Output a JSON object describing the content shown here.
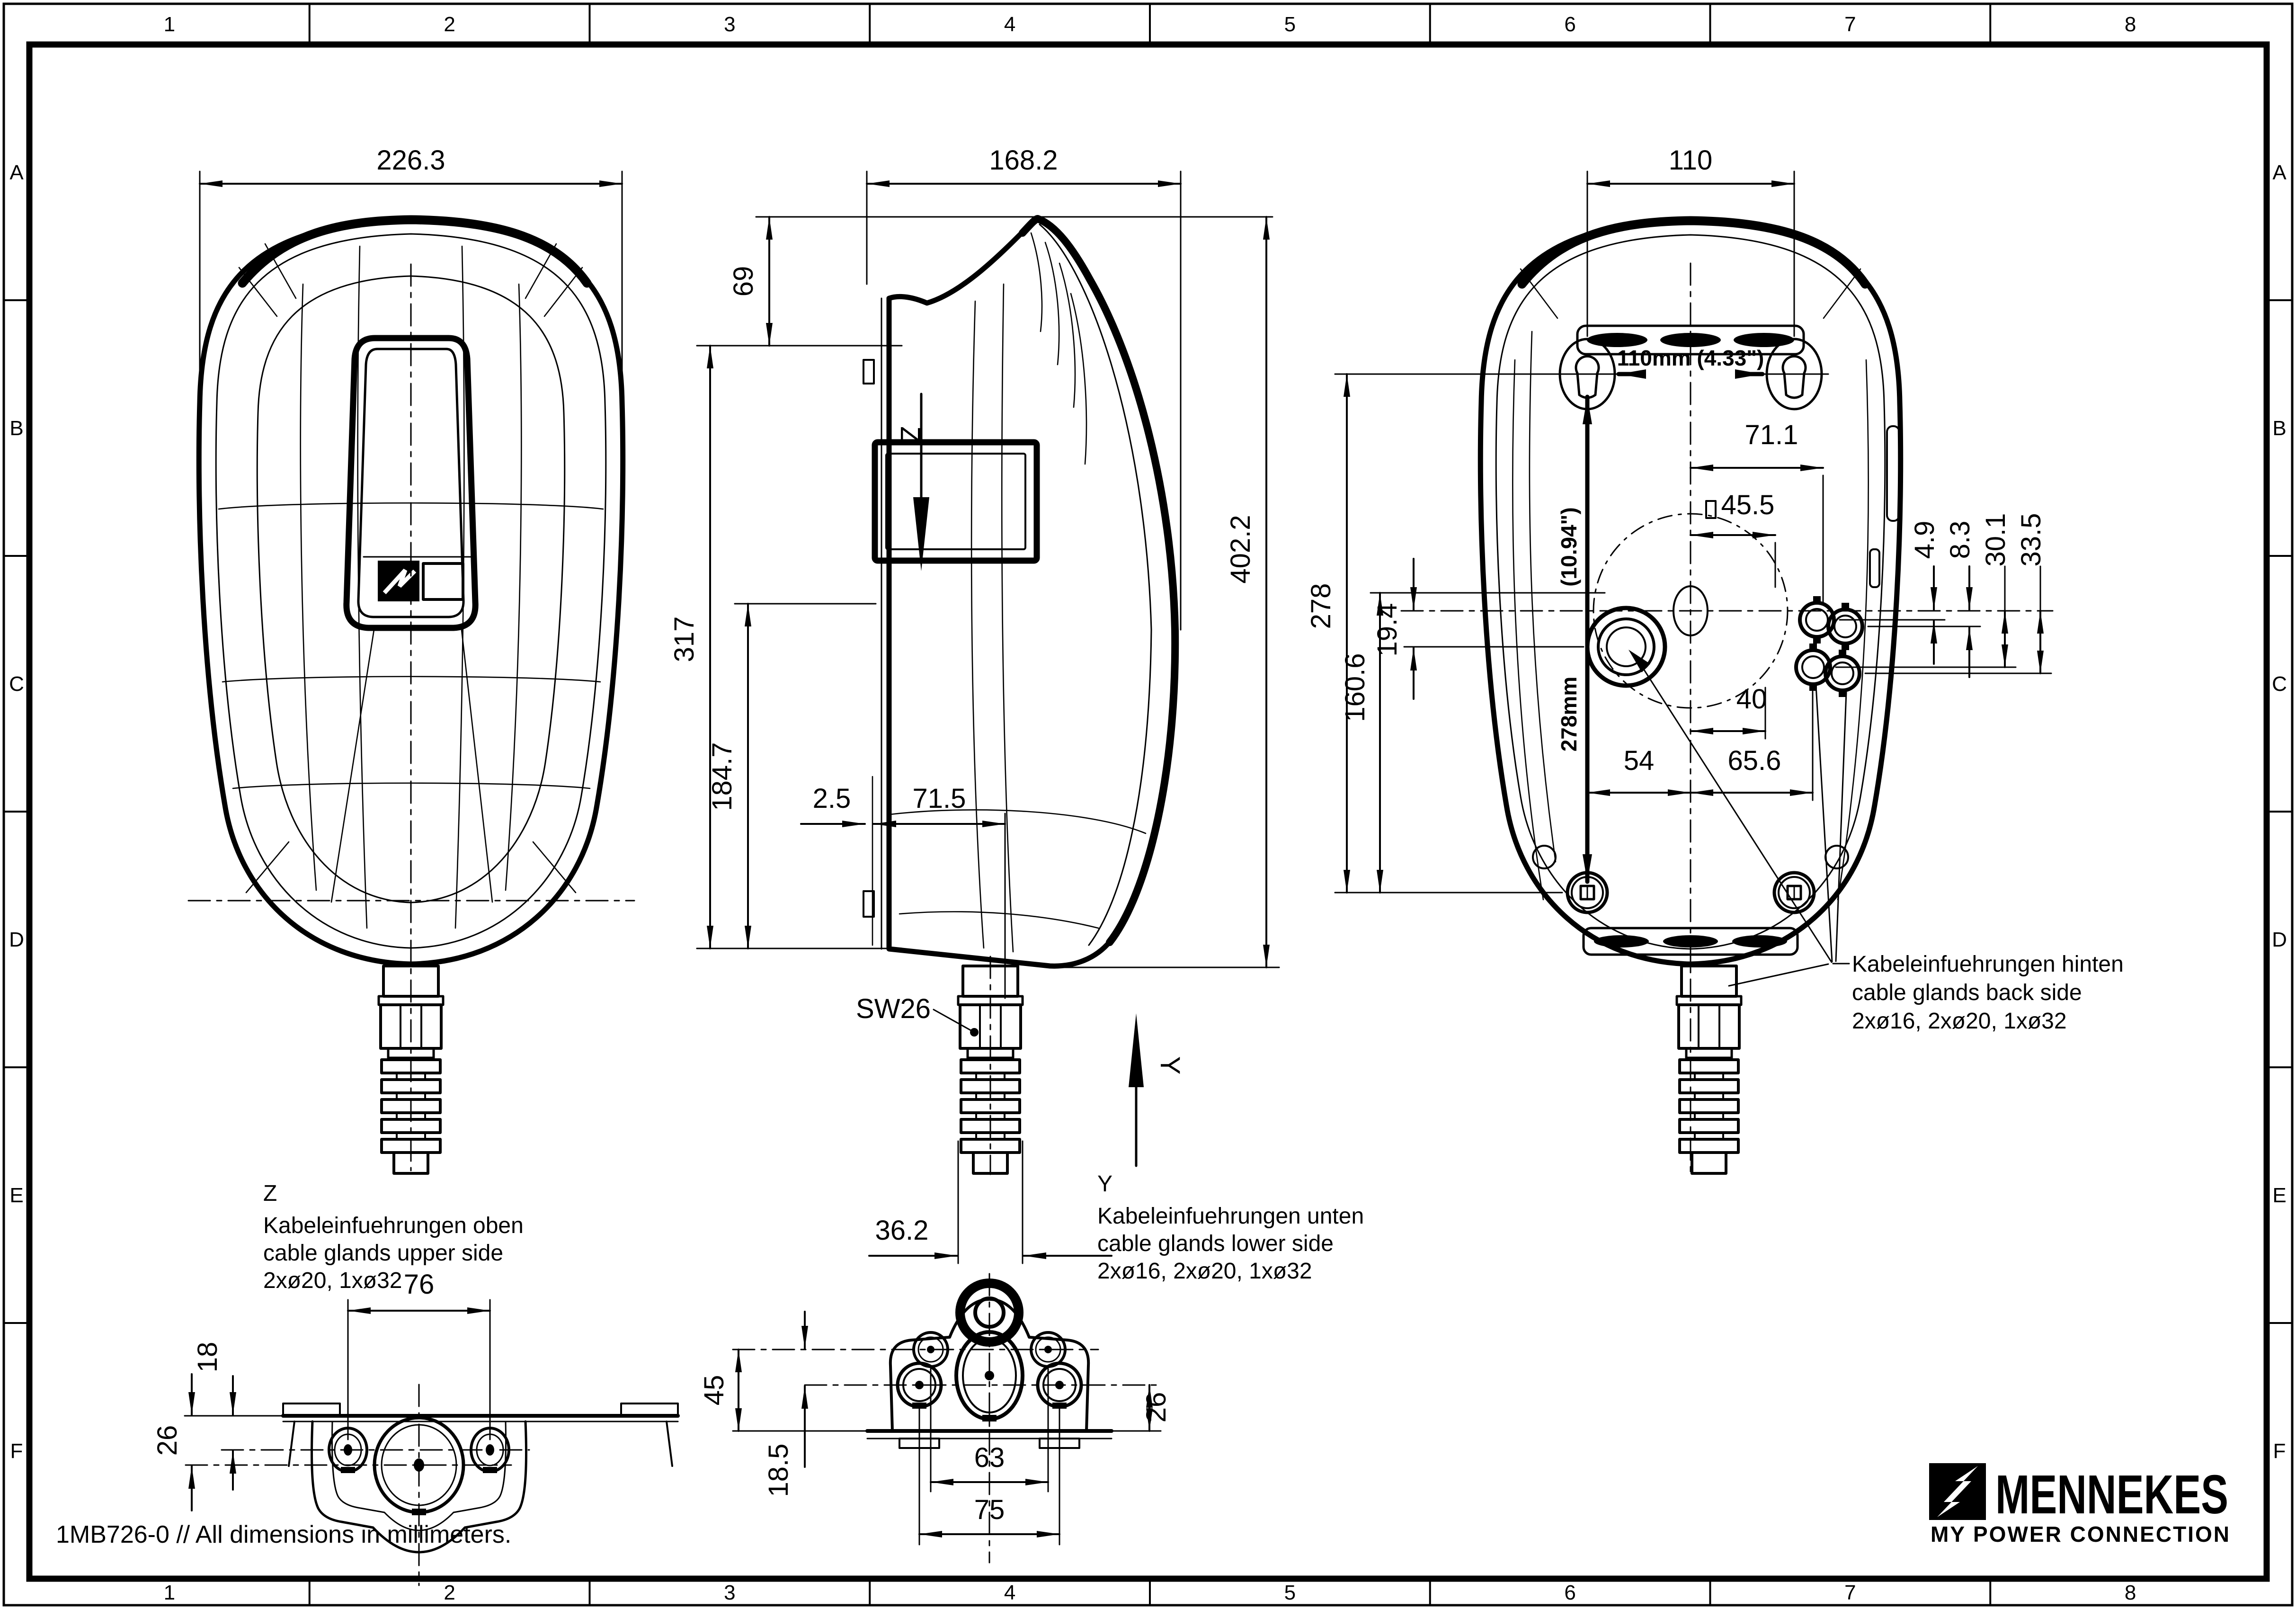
{
  "frame": {
    "cols": [
      "1",
      "2",
      "3",
      "4",
      "5",
      "6",
      "7",
      "8"
    ],
    "rows": [
      "A",
      "B",
      "C",
      "D",
      "E",
      "F"
    ]
  },
  "views": {
    "front": {
      "dims": {
        "width": "226.3"
      }
    },
    "side": {
      "dims": {
        "shoulder": "69",
        "height": "317",
        "panel": "184.7",
        "gap": "2.5",
        "offset": "71.5",
        "total": "402.2",
        "gland": "36.2"
      },
      "labels": {
        "wrench": "SW26",
        "z": "Z",
        "y": "Y"
      }
    },
    "back": {
      "dims": {
        "top": "110",
        "w71": "71.1",
        "w45": "45.5",
        "o49": "4.9",
        "o83": "8.3",
        "o301": "30.1",
        "o335": "33.5",
        "h278": "278",
        "o194": "19.4",
        "h160": "160.6",
        "w40": "40",
        "w54": "54",
        "w65": "65.6"
      },
      "bold": {
        "spacing": "110mm (4.33\")",
        "inches": "(10.94\")",
        "mm": "278mm"
      },
      "note": {
        "lines": [
          "Kabeleinfuehrungen hinten",
          "cable glands back side",
          "2xø16, 2xø20, 1xø32"
        ]
      }
    },
    "detail_z": {
      "label": "Z",
      "lines": [
        "Kabeleinfuehrungen oben",
        "cable glands upper side",
        "2xø20, 1xø32"
      ],
      "dims": {
        "w76": "76",
        "d18": "18",
        "d26": "26"
      }
    },
    "detail_y": {
      "label": "Y",
      "lines": [
        "Kabeleinfuehrungen unten",
        "cable glands lower side",
        "2xø16, 2xø20, 1xø32"
      ],
      "dims": {
        "d45": "45",
        "d185": "18.5",
        "d63": "63",
        "d75": "75",
        "d26": "26"
      }
    }
  },
  "footer": {
    "note": "1MB726-0 // All dimensions in millimeters."
  },
  "brand": {
    "wordmark": "MENNEKES",
    "tagline": "MY  POWER  CONNECTION"
  }
}
